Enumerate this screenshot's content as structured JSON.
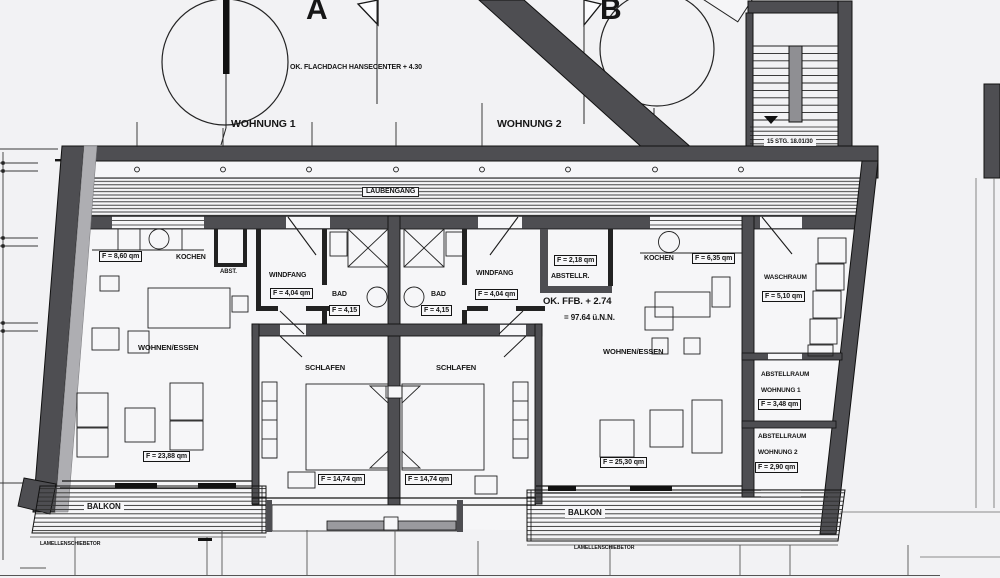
{
  "header": {
    "section_a": "A",
    "section_b": "B",
    "roof_note": "OK. FLACHDACH HANSECENTER + 4.30",
    "apartment1_title": "WOHNUNG 1",
    "apartment2_title": "WOHNUNG 2"
  },
  "stairs": {
    "note": "15 STG. 18.01/30"
  },
  "corridor": {
    "name": "LAUBENGANG"
  },
  "level_note": {
    "line1": "OK. FFB. + 2.74",
    "line2": "= 97.64 ü.N.N."
  },
  "apartment1": {
    "kochen": {
      "name": "KOCHEN",
      "area": "F = 8,60 qm"
    },
    "abstellkammer": {
      "name": "ABST."
    },
    "windfang": {
      "name": "WINDFANG",
      "area": "F = 4,04 qm"
    },
    "bad": {
      "name": "BAD",
      "area": "F = 4,15"
    },
    "wohnen_essen": {
      "name": "WOHNEN/ESSEN",
      "area": "F = 23,88 qm"
    },
    "schlafen": {
      "name": "SCHLAFEN",
      "area": "F = 14,74 qm"
    },
    "balkon": {
      "name": "BALKON"
    },
    "door_note": "LAMELLENSCHIEBETOR"
  },
  "apartment2": {
    "windfang": {
      "name": "WINDFANG",
      "area": "F = 4,04 qm"
    },
    "bad": {
      "name": "BAD",
      "area": "F = 4,15"
    },
    "abstellraum": {
      "name": "ABSTELLR.",
      "area": "F = 2,18 qm"
    },
    "kochen": {
      "name": "KOCHEN",
      "area": "F = 6,35 qm"
    },
    "wohnen_essen": {
      "name": "WOHNEN/ESSEN",
      "area": "F = 25,30 qm"
    },
    "schlafen": {
      "name": "SCHLAFEN",
      "area": "F = 14,74 qm"
    },
    "balkon": {
      "name": "BALKON"
    },
    "door_note": "LAMELLENSCHIEBETOR"
  },
  "service": {
    "waschraum": {
      "name": "WASCHRAUM",
      "area": "F = 5,10 qm"
    },
    "abstellraum_w1": {
      "name_line1": "ABSTELLRAUM",
      "name_line2": "WOHNUNG 1",
      "area": "F = 3,48 qm"
    },
    "abstellraum_w2": {
      "name_line1": "ABSTELLRAUM",
      "name_line2": "WOHNUNG 2",
      "area": "F = 2,90 qm"
    }
  },
  "colors": {
    "paper": "#f2f2f4",
    "wall_dark": "#4e4e52",
    "wall_light": "#aeaeb2",
    "ink": "#1b1b1b"
  }
}
